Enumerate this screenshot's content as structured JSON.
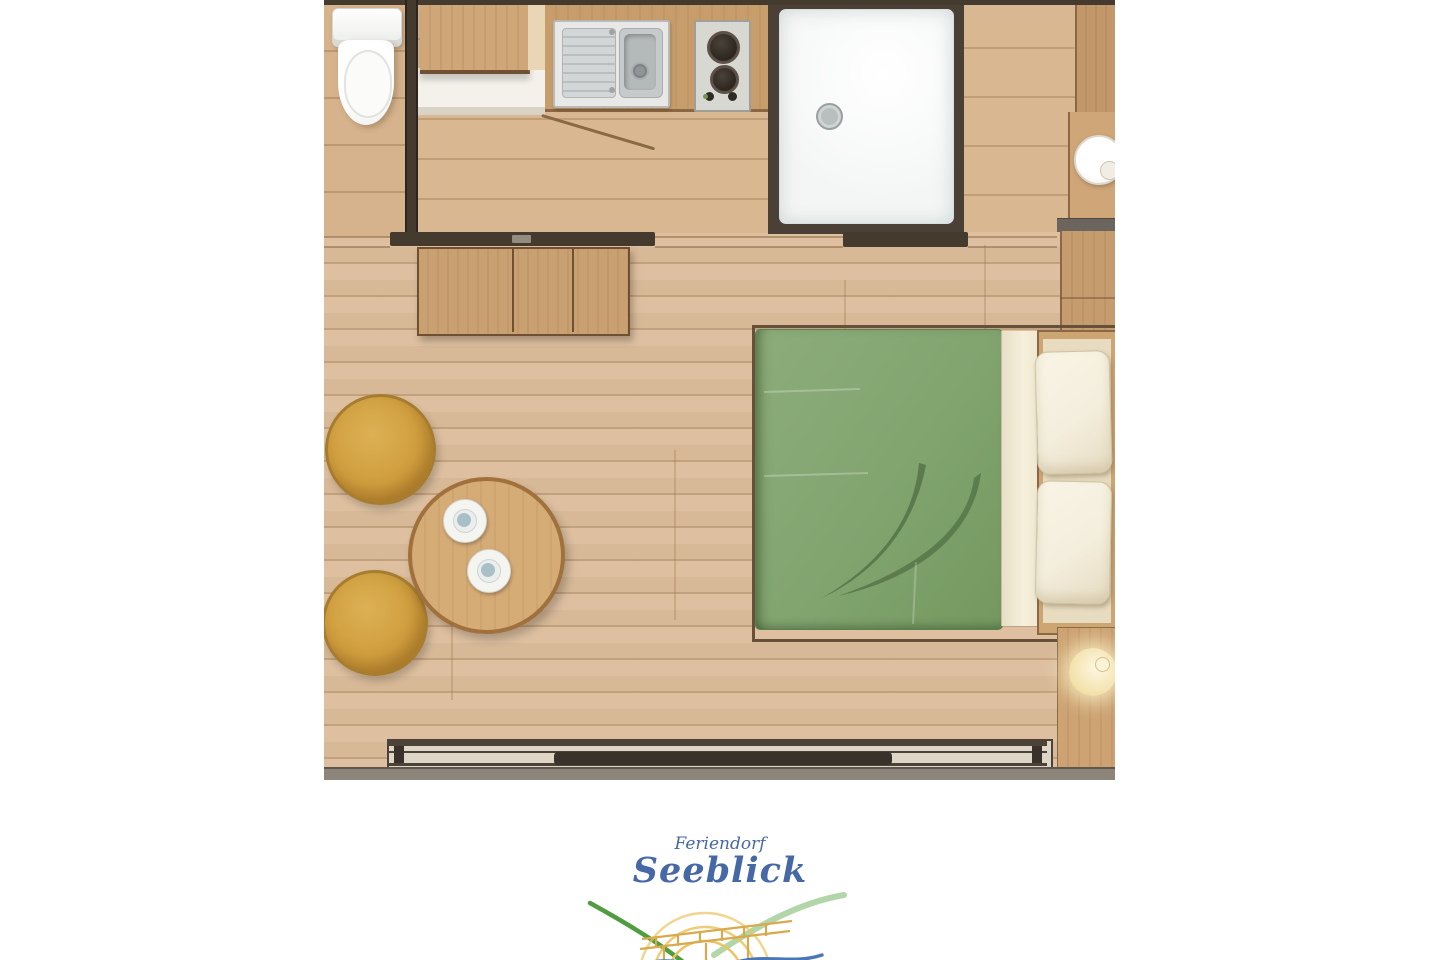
{
  "logo": {
    "brand_line1": "Feriendorf",
    "brand_line2": "Seeblick"
  },
  "theme": {
    "floor_wood": "#dcbd9b",
    "floor_bath": "#d6b38c",
    "floor_hall": "#d9b791",
    "wall_dark": "#453a2e",
    "cabinet_wood": "#cfa678",
    "counter_wood": "#c89d6c",
    "sideboard_wood": "#c9a071",
    "shower_white": "#f4f6f5",
    "frame_dark": "#4a4036",
    "bed_green": "#81a46f",
    "bed_leaf": "#567549",
    "pillow_cream": "#f4eedd",
    "niche_wood": "#cda573",
    "pouf_yellow": "#cf9d3d",
    "pouf_rim": "#a67c2e",
    "table_wood": "#d5ab76",
    "table_rim": "#a1713d",
    "window_glass": "#ddd5c6",
    "strip_gray": "#8d847a",
    "logo_blue": "#4668a6",
    "logo_green_dark": "#4f9c41",
    "logo_green_light": "#b3d6a8",
    "logo_yellow": "#ecc45f",
    "logo_bridge": "#d8a94f",
    "logo_water_dark": "#4a78b6",
    "logo_water_light": "#8fb0d8"
  },
  "floor_plan": {
    "rooms": [
      "bathroom",
      "kitchen",
      "shower-room",
      "dressing-area",
      "living-bedroom",
      "terrace-front"
    ],
    "furniture": [
      "toilet",
      "bathroom-cabinet",
      "kitchen-counter",
      "kitchen-sink",
      "two-burner-cooktop",
      "shower-tray",
      "wardrobe",
      "round-washbasin",
      "sideboard",
      "double-bed-green-duvet",
      "pillow",
      "pillow",
      "bedside-cabinet",
      "nightstand-with-lamp",
      "pouf",
      "pouf",
      "round-coffee-table",
      "coffee-cup",
      "coffee-cup",
      "panoramic-sliding-window"
    ]
  }
}
